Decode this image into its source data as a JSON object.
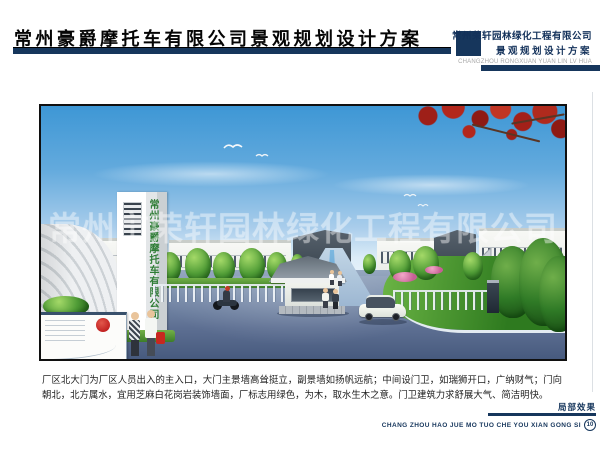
{
  "header": {
    "title": "常州豪爵摩托车有限公司景观规划设计方案",
    "firm_line1": "常州荣轩园林绿化工程有限公司",
    "firm_line2": "景观规划设计方案",
    "firm_pinyin": "CHANGZHOU RONGXUAN YUAN LIN LV HUA"
  },
  "rendering": {
    "monument_text": "常州豪爵摩托车有限公司",
    "watermark_text": "常州市荣轩园林绿化工程有限公司"
  },
  "caption": {
    "text": "厂区北大门为厂区人员出入的主入口，大门主景墙高耸挺立，副景墙如扬帆远航；中间设门卫，如瑞狮开口，广纳财气；门向朝北，北方属水，宜用芝麻白花岗岩装饰墙面，厂标志用绿色，为木，取水生木之意。门卫建筑力求舒展大气、简洁明快。"
  },
  "footer": {
    "label": "局部效果",
    "pinyin": "CHANG ZHOU HAO JUE MO TUO CHE YOU XIAN GONG SI",
    "page_number": "10"
  },
  "colors": {
    "accent_navy": "#16365c",
    "monument_green": "#2f7d36",
    "stamp_red": "#c01f1f",
    "maple_red": "#a32019"
  }
}
